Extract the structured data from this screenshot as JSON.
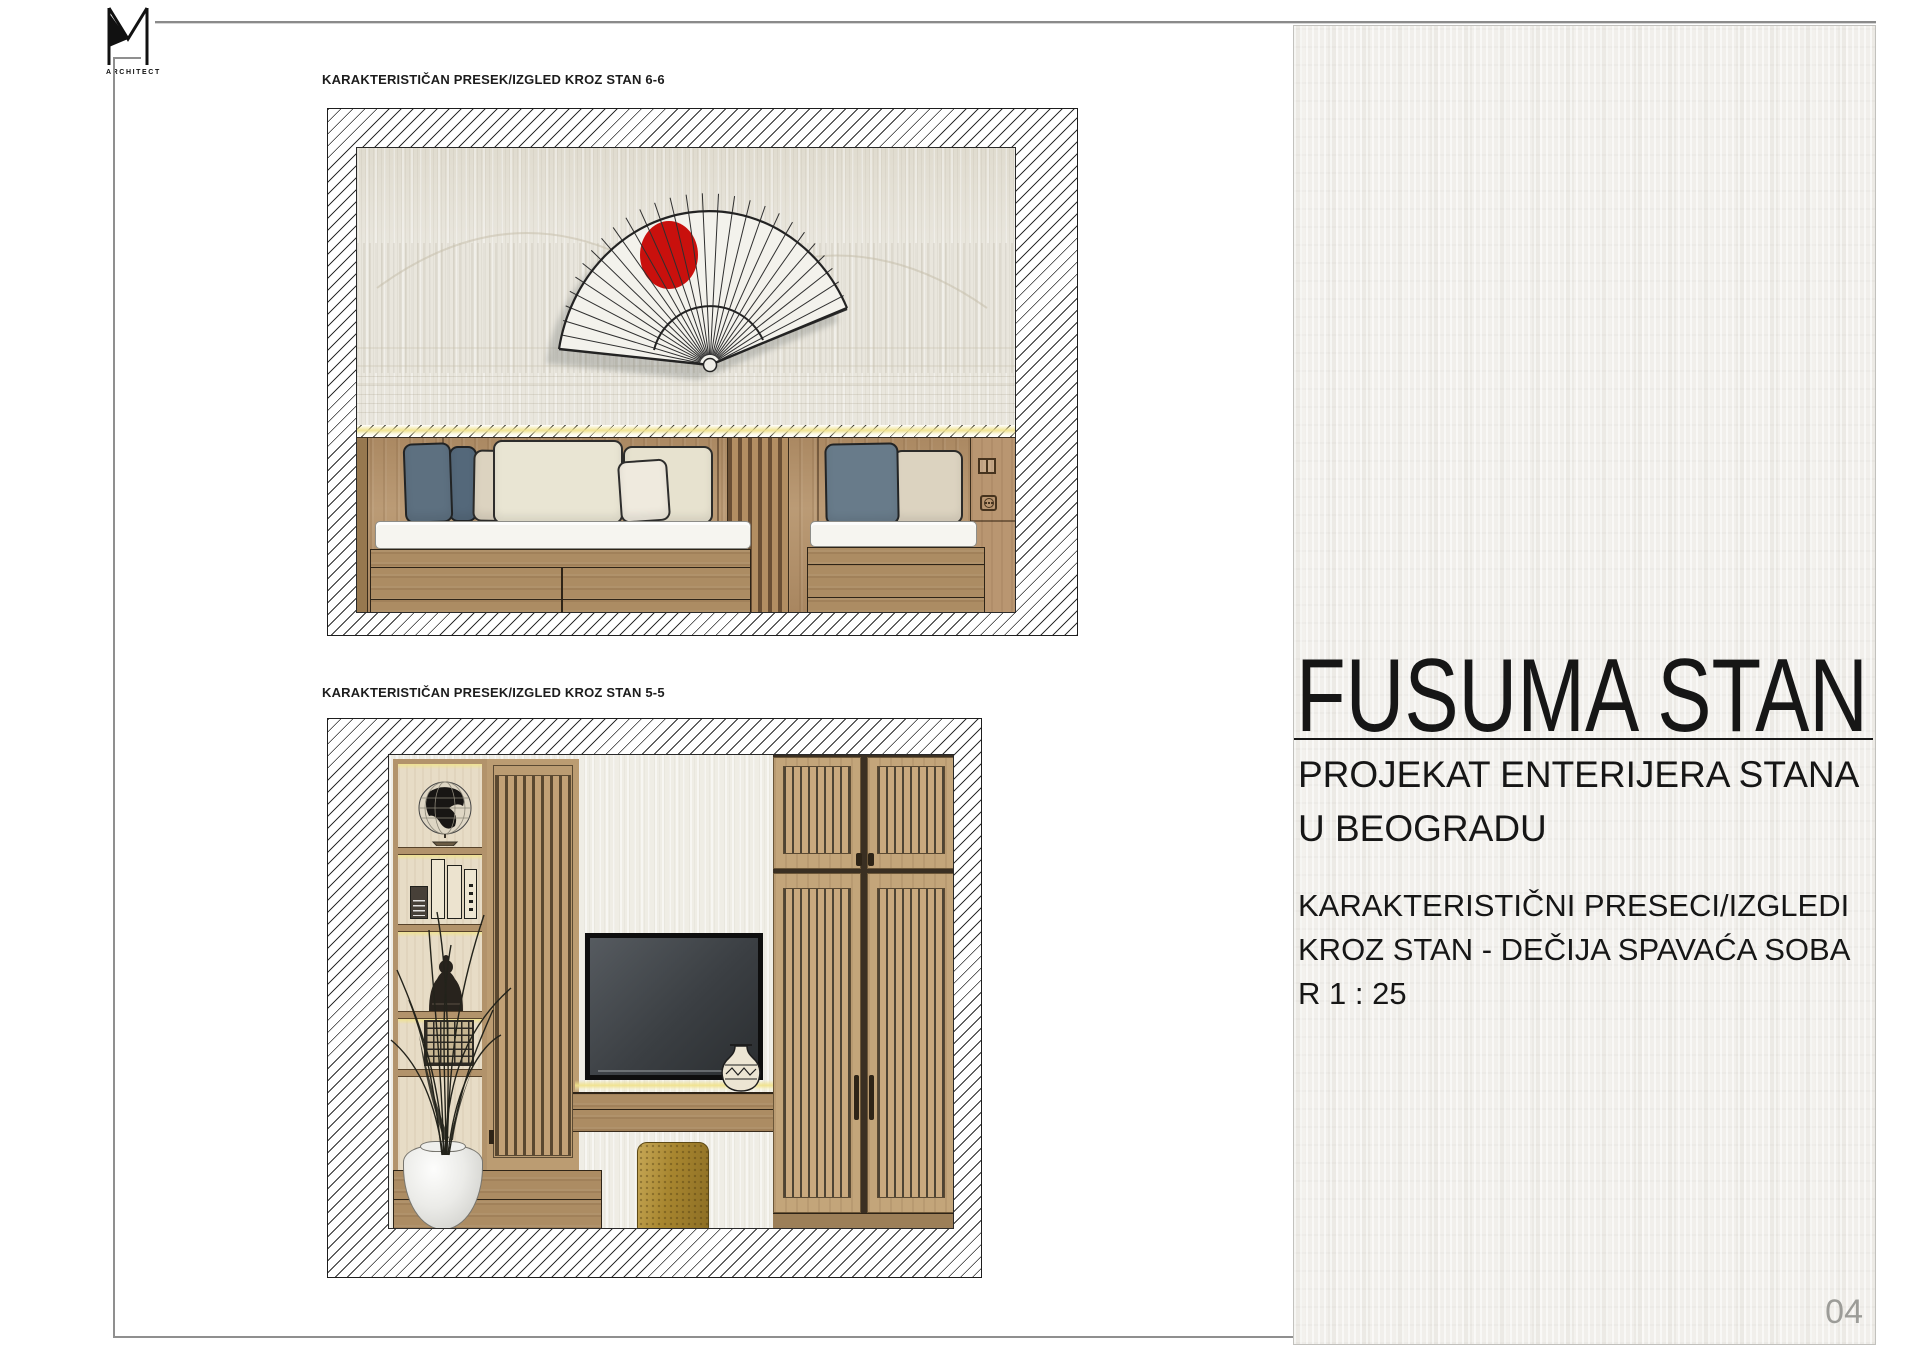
{
  "logo": {
    "mark": "M",
    "label": "ARCHITECT"
  },
  "drawings": [
    {
      "label": "KARAKTERISTIČAN PRESEK/IZGLED KROZ STAN 6-6",
      "scene": "kids bedroom elevation: japanese folding-fan wall art with red sun, LED strip, two wooden beds with pillows, slat panel, switch and socket"
    },
    {
      "label": "KARAKTERISTIČAN PRESEK/IZGLED KROZ STAN 5-5",
      "scene": "media wall elevation: shelf unit with globe, books and figurine, slatted sliding door, TV, counter with decorative vase, gold stool, plant in white vase, slatted wardrobe"
    }
  ],
  "panel": {
    "title": "FUSUMA STAN",
    "subtitle_line1": "PROJEKAT ENTERIJERA STANA",
    "subtitle_line2": "U BEOGRADU",
    "description_line1": "KARAKTERISTIČNI PRESECI/IZGLEDI",
    "description_line2": "KROZ STAN - DEČIJA SPAVAĆA SOBA",
    "description_line3": "R 1 : 25",
    "page_number": "04"
  },
  "colors": {
    "accent_red": "#c9100d",
    "wood": "#b3916a",
    "wood_dark_slat": "#50422f",
    "gold_stool": "#a8862f",
    "glow_yellow": "#f0e28c",
    "pillow_blue": "#5d7080",
    "pillow_beige": "#dcd3c0",
    "pillow_cream": "#e9e5d3",
    "mattress_white": "#f6f5f0",
    "tv_screen": "#33373b",
    "panel_background": "#f1efeb",
    "hatch_line": "#2e2e2e",
    "text": "#161616",
    "page_number_gray": "#9c9c98"
  }
}
